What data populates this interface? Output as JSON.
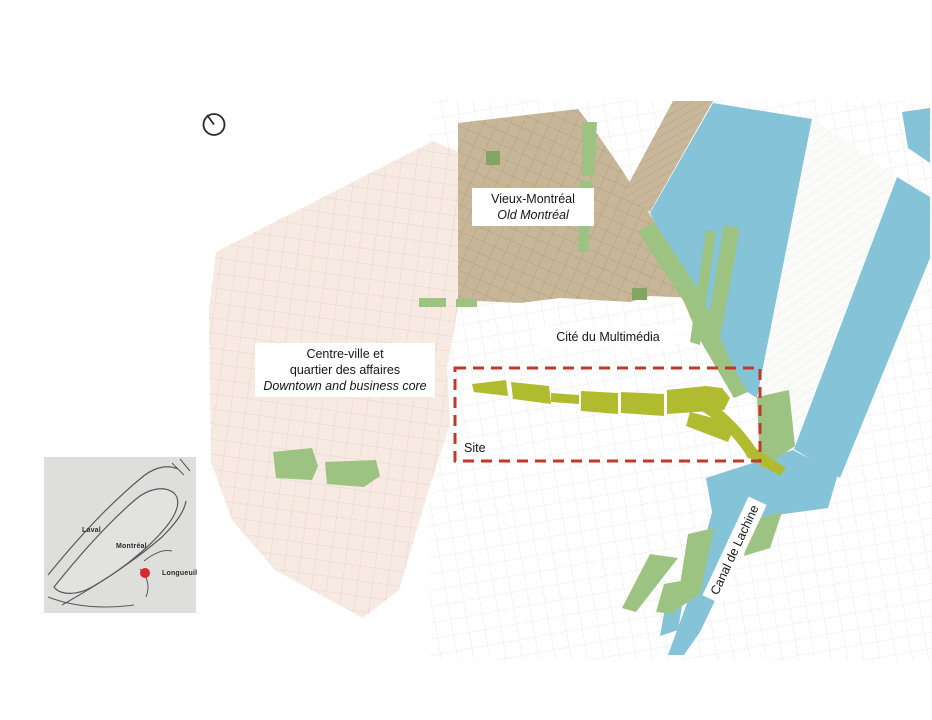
{
  "map": {
    "north_indicator": "north",
    "labels": {
      "vieux_montreal": {
        "line1": "Vieux-Montréal",
        "line2": "Old Montréal"
      },
      "centre_ville": {
        "line1": "Centre-ville et",
        "line2": "quartier des affaires",
        "line3": "Downtown and business core"
      },
      "cite_du_multimedia": "Cité du Multimédia",
      "site": "Site",
      "canal_de_lachine": "Canal de Lachine"
    },
    "zones": {
      "old_montreal_fill": "#C8B699",
      "downtown_fill": "#F6EAE2",
      "water_fill": "#85C3D8",
      "park_fill": "#9CC381",
      "dark_park_fill": "#84A562",
      "site_fill": "#B1BB2F",
      "site_boundary_color": "#BF3A2B"
    }
  },
  "inset": {
    "labels": {
      "laval": "Laval",
      "montreal": "Montréal",
      "longueuil": "Longueuil"
    },
    "marker_color": "#D8282F"
  }
}
